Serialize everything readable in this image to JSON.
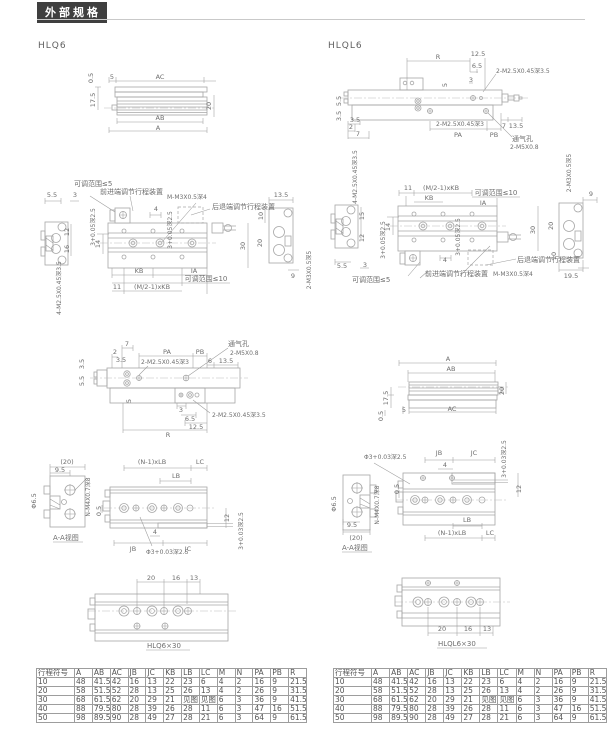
{
  "labels": {
    "title": "外部规格",
    "model_left": "HLQ6",
    "model_right": "HLQL6",
    "v05": "0.5",
    "v2": "2",
    "v3": "3",
    "v35": "3.5",
    "v4": "4",
    "v5": "5",
    "v55": "5.5",
    "v6": "6",
    "v65": "6.5",
    "v7": "7",
    "v9": "9",
    "v95": "9.5",
    "v10": "10",
    "v11": "11",
    "v12": "12",
    "v125": "12.5",
    "v13": "13",
    "v135": "13.5",
    "v14": "14",
    "v15": "15",
    "v16": "16",
    "v175": "17.5",
    "v195": "19.5",
    "v20": "20",
    "v20p": "(20)",
    "v30": "30",
    "a": "A",
    "ab": "AB",
    "ac": "AC",
    "r": "R",
    "pa": "PA",
    "pb": "PB",
    "kb": "KB",
    "ia": "IA",
    "jb": "JB",
    "jc": "JC",
    "lb": "LB",
    "lc": "LC",
    "mkb": "(M/2-1)xKB",
    "nlb": "(N-1)xLB",
    "t2m25_35": "2-M2.5X0.45深3.5",
    "t2m25_3": "2-M2.5X0.45深3",
    "t4m25_35": "4-M2.5X0.45深3.5",
    "t2m3_5": "2-M3X0.5深5",
    "t2m5": "2-M5X0.8",
    "tmm3": "M-M3X0.5深4",
    "tnm4": "N-M4X0.7深8",
    "phi3_03": "Φ3+0.03深2.5",
    "p3_03": "3+0.03深2.5",
    "p3_05": "3+0.05深2.5",
    "phi65": "Φ6.5",
    "vent": "通气孔",
    "adj5": "可调范围≤5",
    "adj10": "可调范围≤10",
    "front_dev": "前进端调节行程装置",
    "rear_dev": "后退端调节行程装置",
    "aa": "A-A视图",
    "cap_left": "HLQ6×30",
    "cap_right": "HLQL6×30"
  },
  "table": {
    "headers": [
      "行程符号",
      "A",
      "AB",
      "AC",
      "JB",
      "JC",
      "KB",
      "LB",
      "LC",
      "M",
      "N",
      "PA",
      "PB",
      "R"
    ],
    "rows": [
      [
        "10",
        "48",
        "41.5",
        "42",
        "16",
        "13",
        "22",
        "23",
        "6",
        "4",
        "2",
        "16",
        "9",
        "21.5"
      ],
      [
        "20",
        "58",
        "51.5",
        "52",
        "28",
        "13",
        "25",
        "26",
        "13",
        "4",
        "2",
        "26",
        "9",
        "31.5"
      ],
      [
        "30",
        "68",
        "61.5",
        "62",
        "20",
        "29",
        "21",
        "见图",
        "见图",
        "6",
        "3",
        "36",
        "9",
        "41.5"
      ],
      [
        "40",
        "88",
        "79.5",
        "80",
        "28",
        "39",
        "26",
        "28",
        "11",
        "6",
        "3",
        "47",
        "16",
        "51.5"
      ],
      [
        "50",
        "98",
        "89.5",
        "90",
        "28",
        "49",
        "27",
        "28",
        "21",
        "6",
        "3",
        "64",
        "9",
        "61.5"
      ]
    ]
  }
}
